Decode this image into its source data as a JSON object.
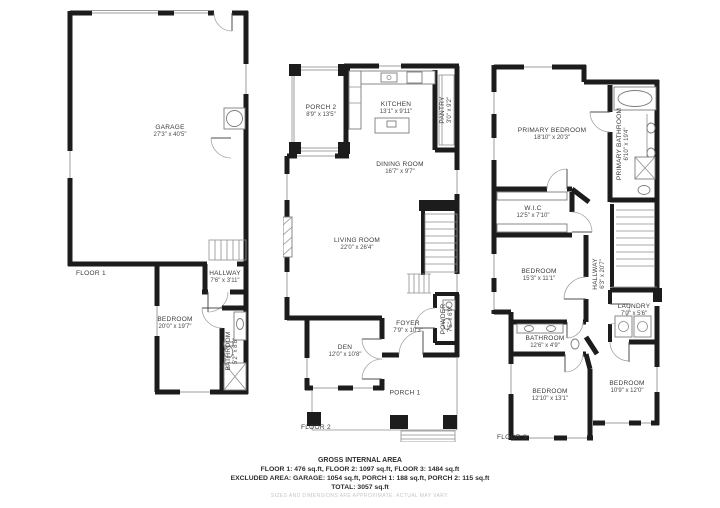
{
  "title": "GROSS INTERNAL AREA",
  "colors": {
    "wall": "#1c1c1c",
    "thin_line": "#8f8f8f",
    "label_text": "#3a3a3a",
    "background": "#ffffff",
    "disclaimer": "#c6c6c6"
  },
  "floors": [
    {
      "label": "FLOOR 1",
      "rooms": [
        {
          "name": "GARAGE",
          "dims": "27'3\" x 40'5\""
        },
        {
          "name": "HALLWAY",
          "dims": "7'6\" x 3'11\""
        },
        {
          "name": "BEDROOM",
          "dims": "20'0\" x 19'7\""
        },
        {
          "name": "BATHROOM",
          "dims": "5'2\" x 8'8\""
        }
      ]
    },
    {
      "label": "FLOOR 2",
      "rooms": [
        {
          "name": "PORCH 2",
          "dims": "8'9\" x 13'5\""
        },
        {
          "name": "KITCHEN",
          "dims": "13'1\" x 9'11\""
        },
        {
          "name": "PANTRY",
          "dims": "3'0\" x 9'2\""
        },
        {
          "name": "DINING ROOM",
          "dims": "16'7\" x 9'7\""
        },
        {
          "name": "LIVING ROOM",
          "dims": "22'0\" x 26'4\""
        },
        {
          "name": "POWDER",
          "dims": "7'5\" x 6'9\""
        },
        {
          "name": "FOYER",
          "dims": "7'9\" x 10'3\""
        },
        {
          "name": "DEN",
          "dims": "12'0\" x 10'8\""
        },
        {
          "name": "PORCH 1",
          "dims": ""
        }
      ]
    },
    {
      "label": "FLOOR 3",
      "rooms": [
        {
          "name": "PRIMARY BEDROOM",
          "dims": "18'10\" x 20'3\""
        },
        {
          "name": "PRIMARY BATHROOM",
          "dims": "6'10\" x 19'4\""
        },
        {
          "name": "W.I.C",
          "dims": "12'5\" x 7'10\""
        },
        {
          "name": "BEDROOM",
          "dims": "15'3\" x 11'1\""
        },
        {
          "name": "HALLWAY",
          "dims": "6'3\" x 20'7\""
        },
        {
          "name": "LAUNDRY",
          "dims": "7'0\" x 5'6\""
        },
        {
          "name": "BATHROOM",
          "dims": "12'6\" x 4'9\""
        },
        {
          "name": "BEDROOM",
          "dims": "12'10\" x 13'1\""
        },
        {
          "name": "BEDROOM",
          "dims": "10'9\" x 12'0\""
        }
      ]
    }
  ],
  "footer": {
    "title": "GROSS INTERNAL AREA",
    "line1": "FLOOR 1: 476 sq.ft, FLOOR 2: 1097 sq.ft, FLOOR 3: 1484 sq.ft",
    "line2": "EXCLUDED AREA: GARAGE: 1054 sq.ft, PORCH 1: 188 sq.ft, PORCH 2: 115 sq.ft",
    "line3": "TOTAL: 3057 sq.ft",
    "disclaimer": "SIZES AND DIMENSIONS ARE APPROXIMATE. ACTUAL MAY VARY."
  }
}
